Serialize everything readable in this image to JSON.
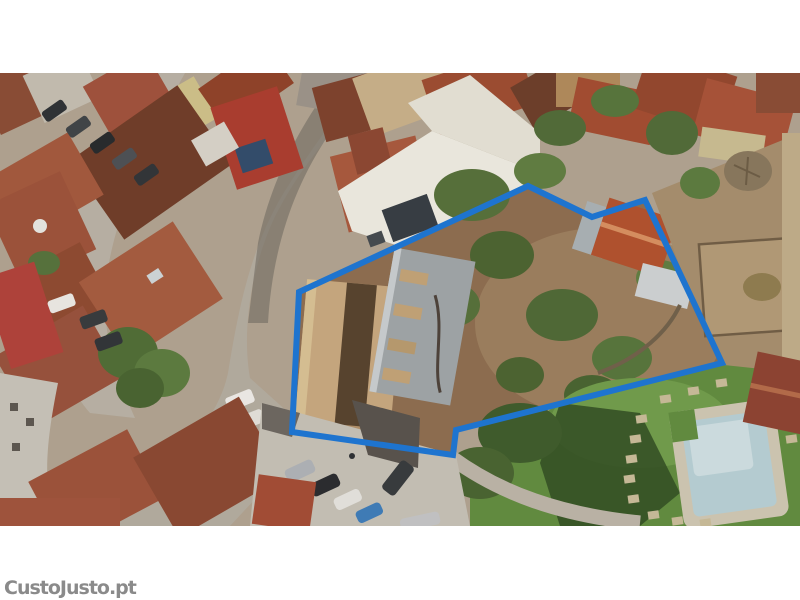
{
  "watermark": {
    "text": "CustoJusto.pt",
    "color": "#8a8a8a",
    "outline_color": "#ffffff"
  },
  "photo": {
    "kind": "aerial-drone-photograph",
    "description": "Top-down aerial view of a village plot for sale: blue polygon outlines a property containing old warehouse roofs and an overgrown dirt garden; surrounded by terracotta rooftops, narrow streets with parked cars, a neighbouring lawn with swimming pool at bottom right.",
    "boundary": {
      "color": "#1e74cf",
      "stroke_width": 6,
      "points": "299,219 528,113 592,144 645,127 694,230 722,290 456,357 453,382 292,359"
    },
    "colors": {
      "boundary_blue": "#1e74cf",
      "dirt_garden": "#8d6c4e",
      "lawn_green": "#5f8c3e",
      "pool_water": "#b7d0d6",
      "roof_terracotta": "#a2553a",
      "street_gray": "#c3bcb0",
      "white_terrace": "#efede3"
    },
    "objects": [
      "terracotta rooftops",
      "white terrace roof",
      "barn roof",
      "corrugated metal roof",
      "dirt garden with shrubs",
      "fenced yard",
      "swimming pool",
      "lawn with stepping stones",
      "parking area with six cars",
      "streets with parked cars",
      "trees"
    ]
  },
  "frame": {
    "background": "#ffffff",
    "photo_top_px": 73,
    "photo_height_px": 453
  }
}
